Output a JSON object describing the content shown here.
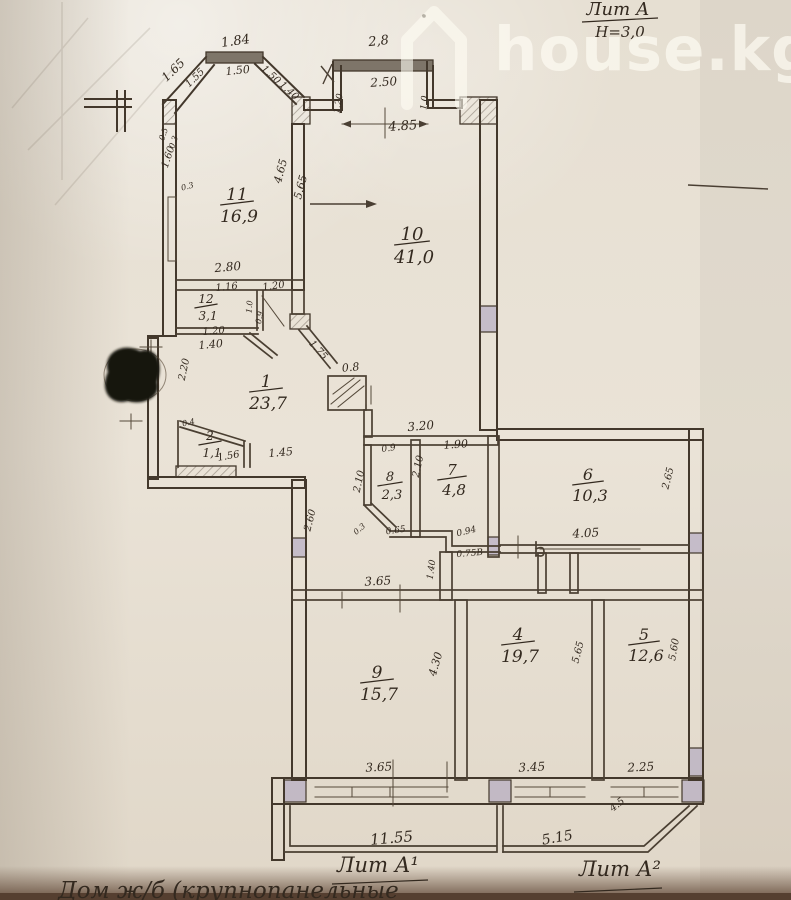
{
  "colors": {
    "paper": "#e7e0d4",
    "ink": "#43382c",
    "shade_block": "#a79fc0",
    "watermark": "#fffdf4",
    "photo_edge": "#553f30"
  },
  "watermark": {
    "text": "house.kg",
    "icon": "house-icon"
  },
  "title_block": {
    "liter": "Лит А",
    "height_note": "Н=3,0"
  },
  "footer": {
    "liter_left": "Лит А¹",
    "liter_right": "Лит А²",
    "note": "Дом ж/б (крупнопанельные"
  },
  "rooms": [
    {
      "n": "11",
      "a": "16,9",
      "x": 237,
      "y": 200,
      "s": 16
    },
    {
      "n": "10",
      "a": "41,0",
      "x": 412,
      "y": 240,
      "s": 17
    },
    {
      "n": "12",
      "a": "3,1",
      "x": 206,
      "y": 303,
      "s": 11
    },
    {
      "n": "1",
      "a": "23,7",
      "x": 266,
      "y": 387,
      "s": 16
    },
    {
      "n": "2",
      "a": "1,1",
      "x": 210,
      "y": 440,
      "s": 11
    },
    {
      "n": "8",
      "a": "2,3",
      "x": 390,
      "y": 481,
      "s": 12
    },
    {
      "n": "7",
      "a": "4,8",
      "x": 452,
      "y": 475,
      "s": 14
    },
    {
      "n": "6",
      "a": "10,3",
      "x": 588,
      "y": 480,
      "s": 15
    },
    {
      "n": "9",
      "a": "15,7",
      "x": 377,
      "y": 678,
      "s": 16
    },
    {
      "n": "4",
      "a": "19,7",
      "x": 518,
      "y": 640,
      "s": 16
    },
    {
      "n": "5",
      "a": "12,6",
      "x": 644,
      "y": 640,
      "s": 15
    }
  ],
  "dimensions": [
    {
      "t": "1.84",
      "x": 236,
      "y": 45,
      "r": -8,
      "s": 13
    },
    {
      "t": "1.50",
      "x": 238,
      "y": 74,
      "r": -6,
      "s": 11
    },
    {
      "t": "1.65",
      "x": 176,
      "y": 73,
      "r": -44,
      "s": 12
    },
    {
      "t": "1.55",
      "x": 197,
      "y": 80,
      "r": -44,
      "s": 10
    },
    {
      "t": "1.50",
      "x": 269,
      "y": 77,
      "r": 42,
      "s": 10
    },
    {
      "t": "1.40",
      "x": 287,
      "y": 93,
      "r": 42,
      "s": 10
    },
    {
      "t": "2,8",
      "x": 379,
      "y": 45,
      "r": -6,
      "s": 13
    },
    {
      "t": "2.50",
      "x": 384,
      "y": 86,
      "r": -4,
      "s": 12
    },
    {
      "t": "1.20",
      "x": 341,
      "y": 104,
      "r": -80,
      "s": 9
    },
    {
      "t": "1.0",
      "x": 427,
      "y": 103,
      "r": -84,
      "s": 9
    },
    {
      "t": "4.85",
      "x": 403,
      "y": 130,
      "r": -4,
      "s": 13
    },
    {
      "t": "0.5",
      "x": 166,
      "y": 135,
      "r": -70,
      "s": 8
    },
    {
      "t": "0.3",
      "x": 176,
      "y": 143,
      "r": -70,
      "s": 8
    },
    {
      "t": "1.60",
      "x": 171,
      "y": 158,
      "r": -72,
      "s": 10
    },
    {
      "t": "0.3",
      "x": 188,
      "y": 189,
      "r": -15,
      "s": 8
    },
    {
      "t": "4.65",
      "x": 284,
      "y": 172,
      "r": -75,
      "s": 11
    },
    {
      "t": "5.65",
      "x": 304,
      "y": 188,
      "r": -75,
      "s": 11
    },
    {
      "t": "2.80",
      "x": 228,
      "y": 271,
      "r": -5,
      "s": 12
    },
    {
      "t": "1.16",
      "x": 227,
      "y": 290,
      "r": -6,
      "s": 10
    },
    {
      "t": "1.20",
      "x": 274,
      "y": 289,
      "r": -8,
      "s": 10
    },
    {
      "t": "1.0",
      "x": 252,
      "y": 307,
      "r": -85,
      "s": 8
    },
    {
      "t": "0.9",
      "x": 262,
      "y": 318,
      "r": -80,
      "s": 8
    },
    {
      "t": "1.20",
      "x": 214,
      "y": 334,
      "r": -5,
      "s": 10
    },
    {
      "t": "1.40",
      "x": 211,
      "y": 348,
      "r": -5,
      "s": 11
    },
    {
      "t": "2.20",
      "x": 187,
      "y": 370,
      "r": -78,
      "s": 10
    },
    {
      "t": "1.75",
      "x": 316,
      "y": 352,
      "r": 48,
      "s": 10
    },
    {
      "t": "0.8",
      "x": 351,
      "y": 371,
      "r": -6,
      "s": 11
    },
    {
      "t": "0.4",
      "x": 189,
      "y": 425,
      "r": -12,
      "s": 8
    },
    {
      "t": "1.56",
      "x": 229,
      "y": 459,
      "r": -10,
      "s": 10
    },
    {
      "t": "1.45",
      "x": 281,
      "y": 456,
      "r": -5,
      "s": 11
    },
    {
      "t": "3.20",
      "x": 421,
      "y": 430,
      "r": -5,
      "s": 12
    },
    {
      "t": "0.9",
      "x": 389,
      "y": 451,
      "r": -8,
      "s": 9
    },
    {
      "t": "2.10",
      "x": 362,
      "y": 482,
      "r": -78,
      "s": 10
    },
    {
      "t": "2.10",
      "x": 421,
      "y": 467,
      "r": -78,
      "s": 10
    },
    {
      "t": "1.90",
      "x": 456,
      "y": 448,
      "r": -4,
      "s": 11
    },
    {
      "t": "0.3",
      "x": 361,
      "y": 531,
      "r": -40,
      "s": 8
    },
    {
      "t": "0.65",
      "x": 396,
      "y": 533,
      "r": -8,
      "s": 9
    },
    {
      "t": "0.94",
      "x": 467,
      "y": 534,
      "r": -14,
      "s": 9
    },
    {
      "t": "0.75В",
      "x": 470,
      "y": 556,
      "r": -5,
      "s": 9
    },
    {
      "t": "2.60",
      "x": 313,
      "y": 521,
      "r": -76,
      "s": 10
    },
    {
      "t": "4.05",
      "x": 586,
      "y": 537,
      "r": -3,
      "s": 12
    },
    {
      "t": "1.40",
      "x": 434,
      "y": 570,
      "r": -82,
      "s": 9
    },
    {
      "t": "2.65",
      "x": 671,
      "y": 479,
      "r": -76,
      "s": 10
    },
    {
      "t": "3.65",
      "x": 378,
      "y": 585,
      "r": -3,
      "s": 12
    },
    {
      "t": "4.30",
      "x": 439,
      "y": 665,
      "r": -74,
      "s": 11
    },
    {
      "t": "5.65",
      "x": 581,
      "y": 653,
      "r": -76,
      "s": 10
    },
    {
      "t": "5.60",
      "x": 677,
      "y": 650,
      "r": -80,
      "s": 10
    },
    {
      "t": "3.65",
      "x": 379,
      "y": 771,
      "r": -3,
      "s": 12
    },
    {
      "t": "3.45",
      "x": 532,
      "y": 771,
      "r": -3,
      "s": 12
    },
    {
      "t": "2.25",
      "x": 641,
      "y": 771,
      "r": -3,
      "s": 12
    },
    {
      "t": "4.5",
      "x": 619,
      "y": 807,
      "r": -38,
      "s": 10
    },
    {
      "t": "11.55",
      "x": 392,
      "y": 843,
      "r": -5,
      "s": 15
    },
    {
      "t": "5.15",
      "x": 558,
      "y": 842,
      "r": -10,
      "s": 14
    }
  ]
}
